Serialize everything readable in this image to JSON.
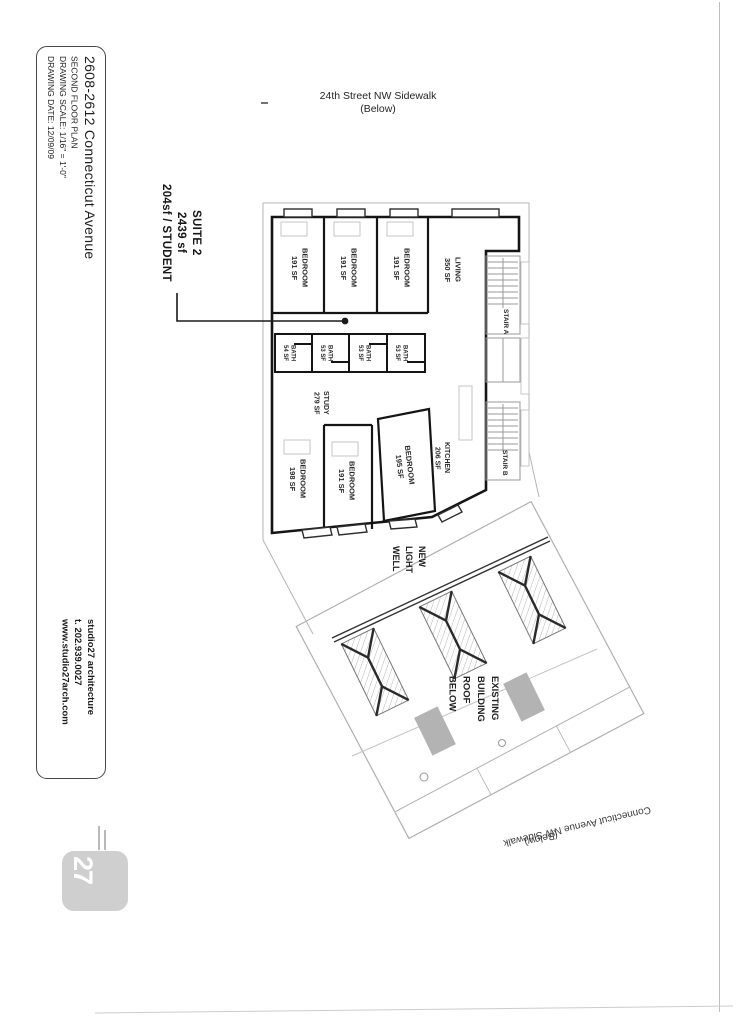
{
  "titleblock": {
    "project_address": "2608-2612 Connecticut Avenue",
    "sheet_name": "SECOND FLOOR PLAN",
    "scale": "DRAWING SCALE: 1/16\" = 1'-0\"",
    "date": "DRAWING DATE: 12/09/09",
    "firm": "studio27 architecture",
    "phone": "t. 202.939.0027",
    "website": "www.studio27arch.com",
    "logo_text": "27"
  },
  "annotations": {
    "street_top_line1": "24th Street NW Sidewalk",
    "street_top_line2": "(Below)",
    "suite_line1": "SUITE 2",
    "suite_line2": "2439 sf",
    "suite_line3": "204sf / STUDENT",
    "light_well_line1": "NEW",
    "light_well_line2": "LIGHT",
    "light_well_line3": "WELL",
    "roof_line1": "EXISTING",
    "roof_line2": "BUILDING",
    "roof_line3": "ROOF",
    "roof_line4": "BELOW",
    "avenue_line1": "Connecticut Avenue NW Sidewalk",
    "avenue_line2": "(Below)"
  },
  "plan": {
    "rooms": [
      {
        "id": "bedroom-1",
        "name": "BEDROOM",
        "area": "191 SF"
      },
      {
        "id": "bedroom-2",
        "name": "BEDROOM",
        "area": "191 SF"
      },
      {
        "id": "bedroom-3",
        "name": "BEDROOM",
        "area": "191 SF"
      },
      {
        "id": "living",
        "name": "LIVING",
        "area": "350 SF"
      },
      {
        "id": "stair-a",
        "name": "STAIR A",
        "area": ""
      },
      {
        "id": "bath-1",
        "name": "BATH",
        "area": "54 SF"
      },
      {
        "id": "bath-2",
        "name": "BATH",
        "area": "53 SF"
      },
      {
        "id": "bath-3",
        "name": "BATH",
        "area": "53 SF"
      },
      {
        "id": "bath-4",
        "name": "BATH",
        "area": "53 SF"
      },
      {
        "id": "study",
        "name": "STUDY",
        "area": "279 SF"
      },
      {
        "id": "kitchen",
        "name": "KITCHEN",
        "area": "206 SF"
      },
      {
        "id": "bedroom-4",
        "name": "BEDROOM",
        "area": "198 SF"
      },
      {
        "id": "bedroom-5",
        "name": "BEDROOM",
        "area": "191 SF"
      },
      {
        "id": "bedroom-6",
        "name": "BEDROOM",
        "area": "195 SF"
      },
      {
        "id": "stair-b",
        "name": "STAIR B",
        "area": ""
      }
    ]
  },
  "colors": {
    "paper": "#ffffff",
    "ink": "#1e1e1e",
    "wall": "#151515",
    "thin_line": "#b5b5b5",
    "logo_gray": "#cfcfcf"
  }
}
